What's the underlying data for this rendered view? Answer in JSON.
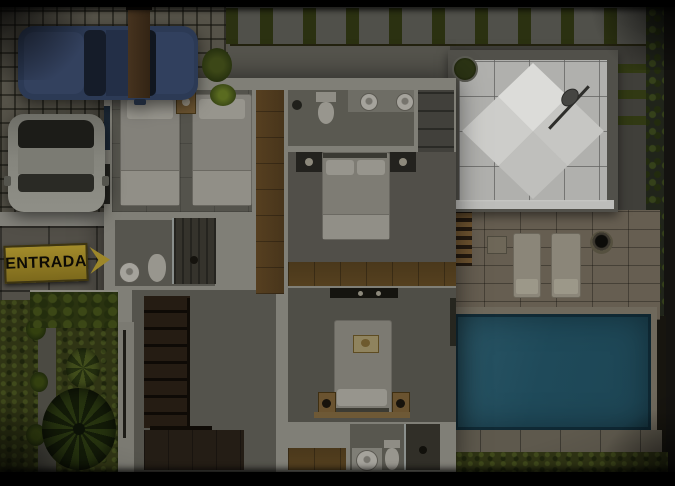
{
  "scene": {
    "type": "3d-floor-plan-render",
    "description": "Top-down 3D architectural render of a modern house upper floor: paver driveway with two cars, yellow ENTRADA arrow sign on a stone wall, side garden with palm tree, three bedrooms, three bathrooms, wooden staircase, roof terrace with white pyramid skylight, stone patio with sun loungers and a swimming pool",
    "sign": {
      "label": "ENTRADA"
    }
  },
  "counts": {
    "cars": 2,
    "beds_total": 4,
    "bedrooms": 3,
    "bathrooms": 3,
    "sun_loungers": 2,
    "pools": 1,
    "staircases": 1,
    "palm_trees": 1
  },
  "colors": {
    "pool_water": "#1f4a5a",
    "grass": "#2f3414",
    "wood_floor": "#53401f",
    "stair_wood": "#1d150e",
    "wall_light": "#807f77",
    "terrace_tile": "#b0b0ad",
    "pyramid_white": "#d7d7d4",
    "driveway_paver": "#565349",
    "patio_stone": "#665e51",
    "car_blue": "#2c3a55",
    "car_white": "#82827a",
    "sign_yellow": "#97822a",
    "sign_text": "#0d0b05",
    "hedge_green": "#2b3111",
    "background_black": "#000000"
  }
}
